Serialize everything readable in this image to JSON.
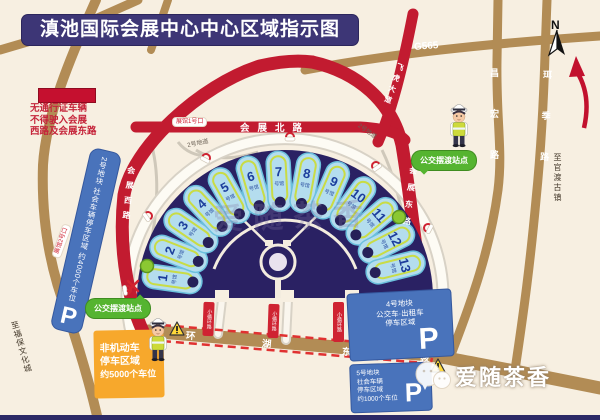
{
  "title": "滇池国际会展中心中心区域指示图",
  "legend": {
    "l1": "无通行证车辆",
    "l2": "不得驶入会展",
    "l3": "西路及会展东路",
    "bar_color": "#c5102f"
  },
  "compass": {
    "label": "N"
  },
  "roads": {
    "g565": "G565",
    "north": "会展北路",
    "west": "会展西路",
    "east": "会展东路",
    "feihu": "飞虎大道",
    "huanhu_chars": [
      "环",
      "湖",
      "东",
      "路"
    ],
    "changhong": "昌宏路",
    "erji": "珥季路",
    "to_guandu": "至官渡古镇",
    "to_fubao": "至福保文化城",
    "plate": "小循环路",
    "gate1": "展馆1号口",
    "gate2": "展馆2号口",
    "tunnel_left": "2号地道",
    "tunnel_right": "2号地道",
    "pedestrian": "行人入口"
  },
  "venue": {
    "halls": [
      1,
      2,
      3,
      4,
      5,
      6,
      7,
      8,
      9,
      10,
      11,
      12,
      13
    ],
    "hall_suffix": "号馆",
    "fan_color": "#2a2163",
    "hall_fill": "#b4ddee"
  },
  "parking": {
    "plot2": {
      "text": "2号地块 社会车辆停车区域 约4000个车位",
      "p": "P"
    },
    "plot4": {
      "l1": "4号地块",
      "l2": "公交车·出租车",
      "l3": "停车区域",
      "p": "P"
    },
    "plot5": {
      "l1": "5号地块",
      "l2": "社会车辆",
      "l3": "停车区域",
      "l4": "约1000个车位",
      "p": "P"
    },
    "nonmotor": {
      "l1": "非机动车",
      "l2": "停车区域",
      "l3": "约5000个车位"
    }
  },
  "shuttle": {
    "label": "公交摆渡站点"
  },
  "watermark": {
    "center": "爱随茶香",
    "bottom": "爱随茶香"
  }
}
